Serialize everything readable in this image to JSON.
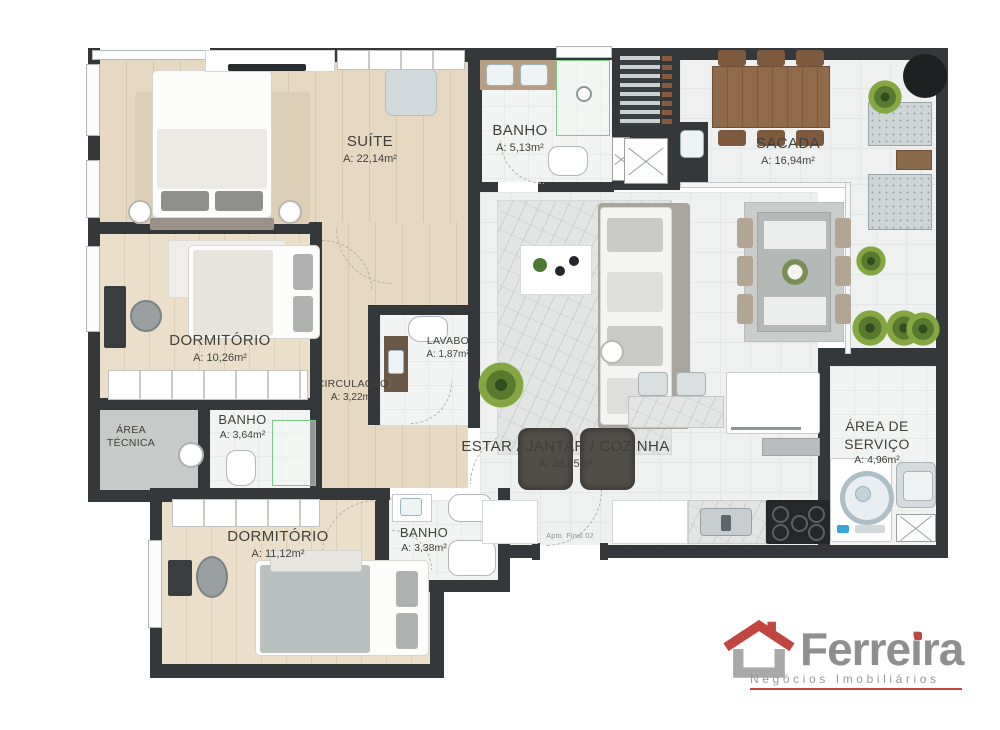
{
  "plan": {
    "unit_label": "Apto. Final 02",
    "rooms": [
      {
        "id": "suite",
        "name": "SUÍTE",
        "area": "A: 22,14m²"
      },
      {
        "id": "banho_suite",
        "name": "BANHO",
        "area": "A: 5,13m²"
      },
      {
        "id": "sacada",
        "name": "SACADA",
        "area": "A: 16,94m²"
      },
      {
        "id": "dormitorio_1",
        "name": "DORMITÓRIO",
        "area": "A: 10,26m²"
      },
      {
        "id": "lavabo",
        "name": "LAVABO",
        "area": "A: 1,87m²"
      },
      {
        "id": "circulacao",
        "name": "CIRCULAÇÃO",
        "area": "A: 3,22m²"
      },
      {
        "id": "area_tecnica",
        "name": "ÁREA TÉCNICA",
        "area": ""
      },
      {
        "id": "banho_social",
        "name": "BANHO",
        "area": "A: 3,64m²"
      },
      {
        "id": "dormitorio_2",
        "name": "DORMITÓRIO",
        "area": "A: 11,12m²"
      },
      {
        "id": "banho_2",
        "name": "BANHO",
        "area": "A: 3,38m²"
      },
      {
        "id": "estar",
        "name": "ESTAR / JANTAR / COZINHA",
        "area": "A: 38,05m²"
      },
      {
        "id": "servico",
        "name": "ÁREA DE SERVIÇO",
        "area": "A: 4,96m²"
      }
    ]
  },
  "logo": {
    "brand": "Ferreira",
    "tagline": "Negócios Imobiliários"
  },
  "colors": {
    "wall": "#34383b",
    "wood_floor": "#e6d6bf",
    "tile_floor": "#eef1f0",
    "glass_green": "#7cc98a",
    "accent_red": "#c0463f",
    "logo_gray": "#8f8f8f",
    "label_text": "#413f3a"
  }
}
